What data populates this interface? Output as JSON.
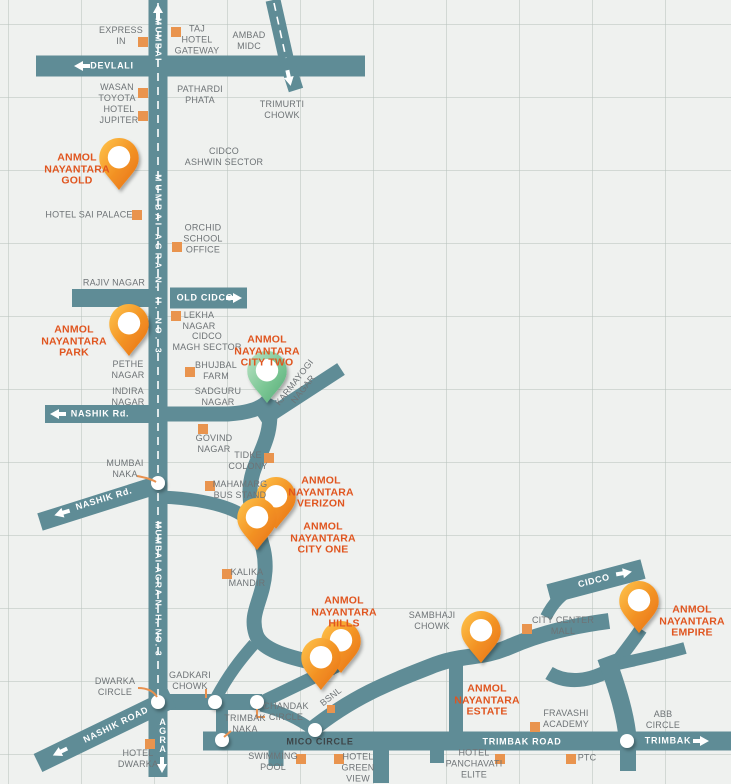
{
  "map_type": "location-map",
  "colors": {
    "road": "#5f8c96",
    "background": "#eff1ef",
    "landmark_text": "#6e7376",
    "accent_text": "#e0551f",
    "landmark_marker": "#e9944e",
    "pin_orange": "#f29022",
    "pin_green": "#7cc795",
    "road_text": "#ffffff"
  },
  "properties": {
    "gold": {
      "name": "ANMOL\nNAYANTARA\nGOLD",
      "pin": "orange",
      "pin_count": 1
    },
    "park": {
      "name": "ANMOL\nNAYANTARA\nPARK",
      "pin": "orange",
      "pin_count": 1
    },
    "city_two": {
      "name": "ANMOL\nNAYANTARA\nCITY TWO",
      "pin": "green",
      "pin_count": 1
    },
    "verizon": {
      "name": "ANMOL\nNAYANTARA\nVERIZON",
      "pin": "orange",
      "pin_count": 2
    },
    "city_one": {
      "name": "ANMOL\nNAYANTARA\nCITY ONE",
      "pin": "orange",
      "pin_count": 0
    },
    "hills": {
      "name": "ANMOL\nNAYANTARA\nHILLS",
      "pin": "orange",
      "pin_count": 2
    },
    "estate": {
      "name": "ANMOL\nNAYANTARA\nESTATE",
      "pin": "orange",
      "pin_count": 1
    },
    "empire": {
      "name": "ANMOL\nNAYANTARA\nEMPIRE",
      "pin": "orange",
      "pin_count": 1
    }
  },
  "road_signs": {
    "mumbai": "MUMBAI",
    "mumbai_agra": "MUMBAI AGRA N. H. NO. 3",
    "agra": "A\nG\nR\nA",
    "devlali": "DEVLALI",
    "old_cidco": "OLD CIDCO",
    "nashik_rd": "NASHIK Rd.",
    "nashik_road": "NASHIK ROAD",
    "cidco": "CIDCO",
    "mico_circle": "MICO CIRCLE",
    "trimbak_road": "TRIMBAK ROAD",
    "trimbak": "TRIMBAK"
  },
  "landmarks": {
    "express_inn": "EXPRESS\nIN",
    "taj_hotel_gateway": "TAJ\nHOTEL\nGATEWAY",
    "ambad_midc": "AMBAD\nMIDC",
    "wasan_toyota": "WASAN\nTOYOTA",
    "pathardi_phata": "PATHARDI\nPHATA",
    "trimurti_chowk": "TRIMURTI\nCHOWK",
    "hotel_jupiter": "HOTEL\nJUPITER",
    "cidco_ashwin_sector": "CIDCO\nASHWIN SECTOR",
    "hotel_sai_palace": "HOTEL SAI PALACE",
    "orchid_school_office": "ORCHID\nSCHOOL\nOFFICE",
    "rajiv_nagar": "RAJIV NAGAR",
    "lekha_nagar": "LEKHA\nNAGAR",
    "cidco_magh_sector": "CIDCO\nMAGH SECTOR",
    "pethe_nagar": "PETHE\nNAGAR",
    "bhujbal_farm": "BHUJBAL\nFARM",
    "indira_nagar": "INDIRA\nNAGAR",
    "sadguru_nagar": "SADGURU\nNAGAR",
    "karmayogi_nagar": "KARMAYOGI\nNAGAR",
    "govind_nagar": "GOVIND\nNAGAR",
    "tidke_colony": "TIDKE\nCOLONY",
    "mumbai_naka": "MUMBAI\nNAKA",
    "mahamarg_bus_stand": "MAHAMARG\nBUS STAND",
    "kalika_mandir": "KALIKA\nMANDIR",
    "sambhaji_chowk": "SAMBHAJI\nCHOWK",
    "city_center_mall": "CITY CENTER\nMALL",
    "bsnl": "BSNL",
    "dwarka_circle": "DWARKA\nCIRCLE",
    "gadkari_chowk": "GADKARI\nCHOWK",
    "chandak_circle": "CHANDAK\nCIRCLE",
    "trimbak_naka": "TRIMBAK\nNAKA",
    "abb_circle": "ABB\nCIRCLE",
    "fravashi_academy": "FRAVASHI\nACADEMY",
    "ptc": "PTC",
    "swimming_pool": "SWIMMING\nPOOL",
    "hotel_green_view": "HOTEL\nGREEN\nVIEW",
    "hotel_panchavati_elite": "HOTEL\nPANCHAVATI\nELITE",
    "hotel_dwarka": "HOTEL\nDWARKA"
  }
}
